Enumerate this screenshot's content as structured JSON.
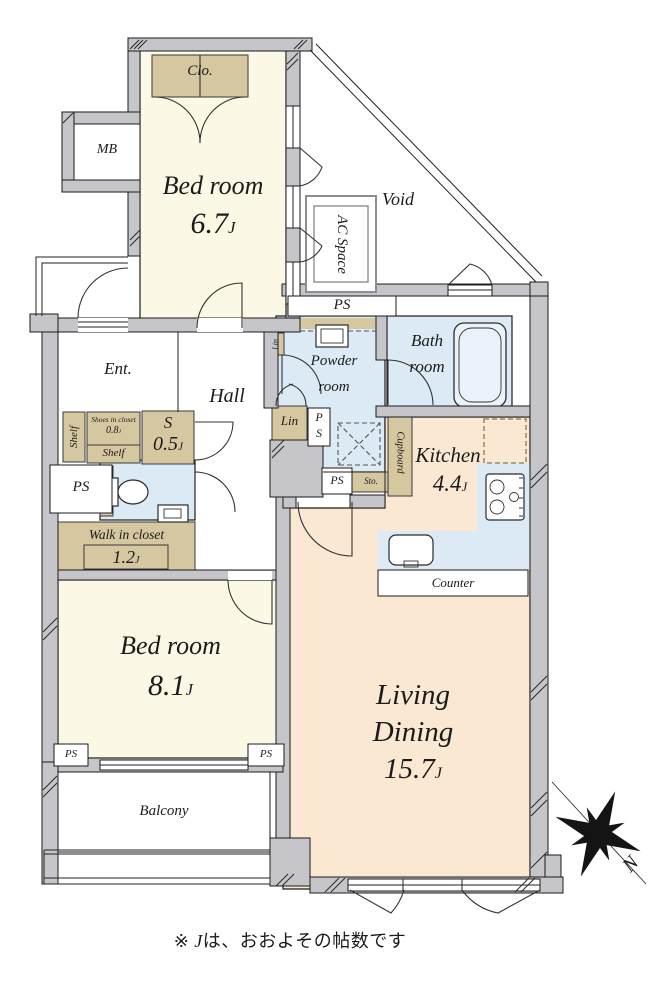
{
  "rooms": {
    "bedroom_1": {
      "name": "Bed room",
      "area": "6.7",
      "unit": "J"
    },
    "bedroom_2": {
      "name": "Bed room",
      "area": "8.1",
      "unit": "J"
    },
    "living_dining": {
      "line1": "Living",
      "line2": "Dining",
      "area": "15.7",
      "unit": "J"
    },
    "kitchen": {
      "name": "Kitchen",
      "area": "4.4",
      "unit": "J"
    },
    "bath": {
      "line1": "Bath",
      "line2": "room"
    },
    "powder": {
      "line1": "Powder",
      "line2": "room"
    },
    "entrance": {
      "name": "Ent."
    },
    "hall": {
      "name": "Hall"
    },
    "balcony": {
      "name": "Balcony"
    },
    "void": {
      "name": "Void"
    },
    "ac_space": {
      "name": "AC Space"
    },
    "walk_in_closet": {
      "name": "Walk in closet",
      "area": "1.2",
      "unit": "J"
    },
    "shoes_closet": {
      "name": "Shoes in closet",
      "area": "0.8",
      "unit": "J"
    },
    "storage_s": {
      "name": "S",
      "area": "0.5",
      "unit": "J"
    }
  },
  "labels": {
    "closet": "Clo.",
    "meter_box": "MB",
    "pipe_space": "PS",
    "pipe_space_p": "P",
    "pipe_space_s": "S",
    "linen": "Lin",
    "storage": "Sto.",
    "cupboard": "Cupboard",
    "counter": "Counter",
    "shelf": "Shelf"
  },
  "compass": {
    "north": "N"
  },
  "footnote": {
    "prefix": "※ ",
    "j": "J",
    "suffix": "は、おおよその帖数です"
  },
  "colors": {
    "room_cream": "#FBF8E5",
    "room_peach": "#FAE8D2",
    "room_blue": "#DBEAF4",
    "closet_tan": "#D5C79F",
    "wall_gray": "#C5C5CA"
  }
}
